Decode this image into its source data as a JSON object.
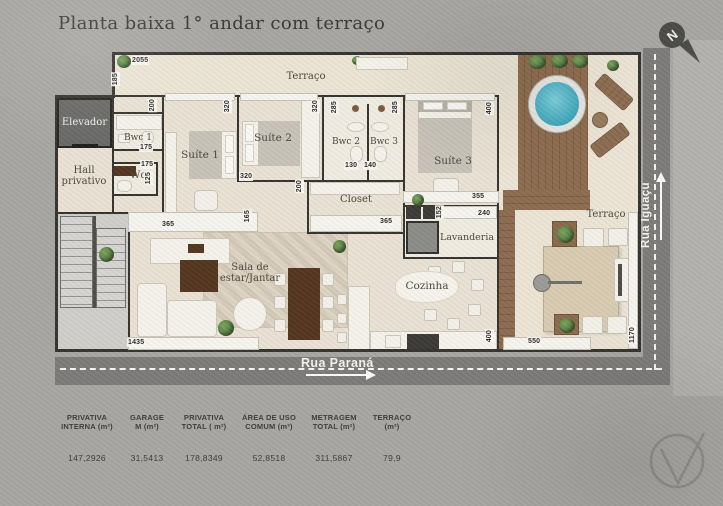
{
  "title": "Planta baixa 1° andar com terraço",
  "compass": {
    "letter": "N"
  },
  "rooms": {
    "elevador": "Elevador",
    "hall": "Hall privativo",
    "wc": "Wc",
    "bwc1": "Bwc 1",
    "suite1": "Suíte 1",
    "suite2": "Suíte 2",
    "bwc2": "Bwc 2",
    "bwc3": "Bwc 3",
    "suite3": "Suíte 3",
    "closet": "Closet",
    "lavanderia": "Lavanderia",
    "sala": "Sala de estar/Jantar",
    "cozinha": "Cozinha",
    "terraco_top": "Terraço",
    "terraco_right": "Terraço"
  },
  "streets": {
    "bottom": "Rua Paraná",
    "right": "Rua Iguaçu"
  },
  "dims": [
    "2055",
    "185",
    "200",
    "320",
    "175",
    "175",
    "125",
    "320",
    "285",
    "285",
    "400",
    "130",
    "140",
    "320",
    "355",
    "200",
    "240",
    "152",
    "365",
    "365",
    "165",
    "1435",
    "400",
    "550",
    "1170"
  ],
  "table": {
    "columns": [
      {
        "l1": "PRIVATIVA",
        "l2": "INTERNA (m²)",
        "value": "147,2926"
      },
      {
        "l1": "GARAGE",
        "l2": "M (m²)",
        "value": "31,5413"
      },
      {
        "l1": "PRIVATIVA",
        "l2": "TOTAL ( m²)",
        "value": "178,8349"
      },
      {
        "l1": "ÁREA DE USO",
        "l2": "COMUM (m²)",
        "value": "52,8518"
      },
      {
        "l1": "METRAGEM",
        "l2": "TOTAL (m²)",
        "value": "311,5867"
      },
      {
        "l1": "TERRAÇO",
        "l2": "(m²)",
        "value": "79,9"
      }
    ]
  },
  "colors": {
    "pool": "#3aa5ba",
    "deck": "#8d6c4f",
    "road": "#7c7b79",
    "wall": "#35332e",
    "floor": "#e9e2d4"
  }
}
